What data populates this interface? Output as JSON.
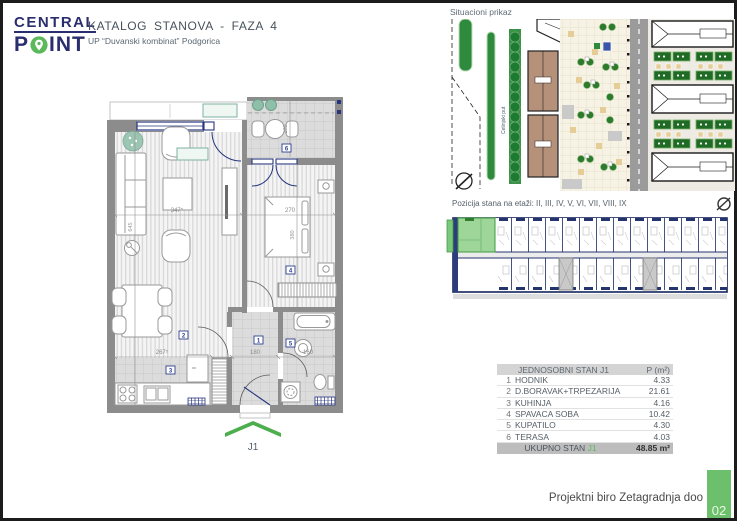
{
  "header": {
    "logo_line1": "CENTRAL",
    "logo_p": "P",
    "logo_rest": "INT",
    "title": "KATALOG STANOVA - FAZA 4",
    "subtitle": "UP “Duvanski kombinat” Podgorica"
  },
  "site_plan": {
    "label": "Situacioni prikaz",
    "street": "Cetinjski put"
  },
  "position": {
    "label": "Pozicija stana na etaži: II, III, IV, V, VI, VII, VIII, IX"
  },
  "floor_plan": {
    "unit_label": "J1",
    "dims": {
      "living_w": "347⁵",
      "living_h": "645",
      "bedroom_w": "270",
      "bedroom_h": "380",
      "kitchen_w": "267⁵",
      "hall_w": "180",
      "bath_w": "160",
      "terrace_h": "170"
    },
    "rooms": {
      "hall": "1",
      "living": "2",
      "kitchen": "3",
      "bedroom": "4",
      "bath": "5",
      "terrace": "6"
    }
  },
  "table": {
    "title": "JEDNOSOBNI STAN J1",
    "area_header": "P (m²)",
    "rows": [
      {
        "num": "1",
        "name": "HODNIK",
        "area": "4.33"
      },
      {
        "num": "2",
        "name": "D.BORAVAK+TRPEZARIJA",
        "area": "21.61"
      },
      {
        "num": "3",
        "name": "KUHINJA",
        "area": "4.16"
      },
      {
        "num": "4",
        "name": "SPAVACA SOBA",
        "area": "10.42"
      },
      {
        "num": "5",
        "name": "KUPATILO",
        "area": "4.30"
      },
      {
        "num": "6",
        "name": "TERASA",
        "area": "4.03"
      }
    ],
    "total_label": "UKUPNO STAN",
    "total_unit": "J1",
    "total_area": "48.85 m²"
  },
  "footer": {
    "studio": "Projektni biro Zetagradnja doo",
    "page": "02"
  },
  "colors": {
    "brand_navy": "#2b2e6e",
    "accent_green": "#5cb85c",
    "wall_gray": "#8c8c8c",
    "plan_navy": "#27357e"
  }
}
